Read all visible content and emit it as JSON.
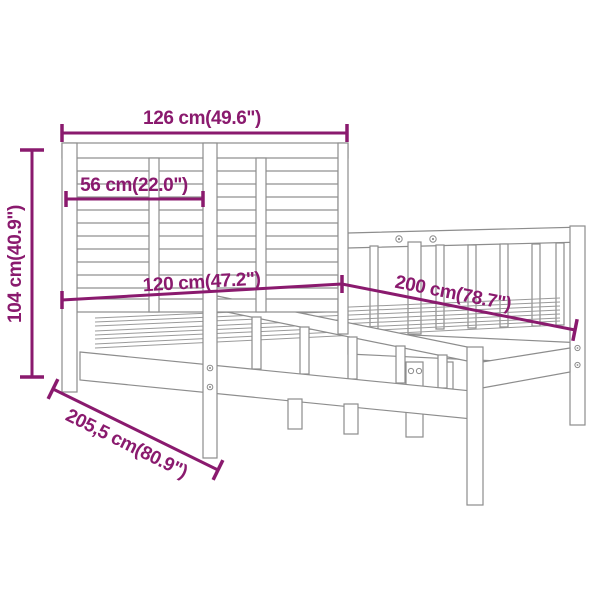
{
  "diagram": {
    "subject": "bed-frame-dimension-diagram",
    "background_color": "#ffffff",
    "sketch_line_color": "#8d8d8d",
    "dimension_color": "#8a1a6e",
    "dimensions": {
      "headboard_width": "126 cm(49.6\")",
      "headboard_panel": "56 cm(22.0\")",
      "bed_width": "120 cm(47.2\")",
      "bed_length": "200 cm(78.7\")",
      "height": "104 cm(40.9\")",
      "total_length": "205,5 cm(80.9\")"
    }
  }
}
